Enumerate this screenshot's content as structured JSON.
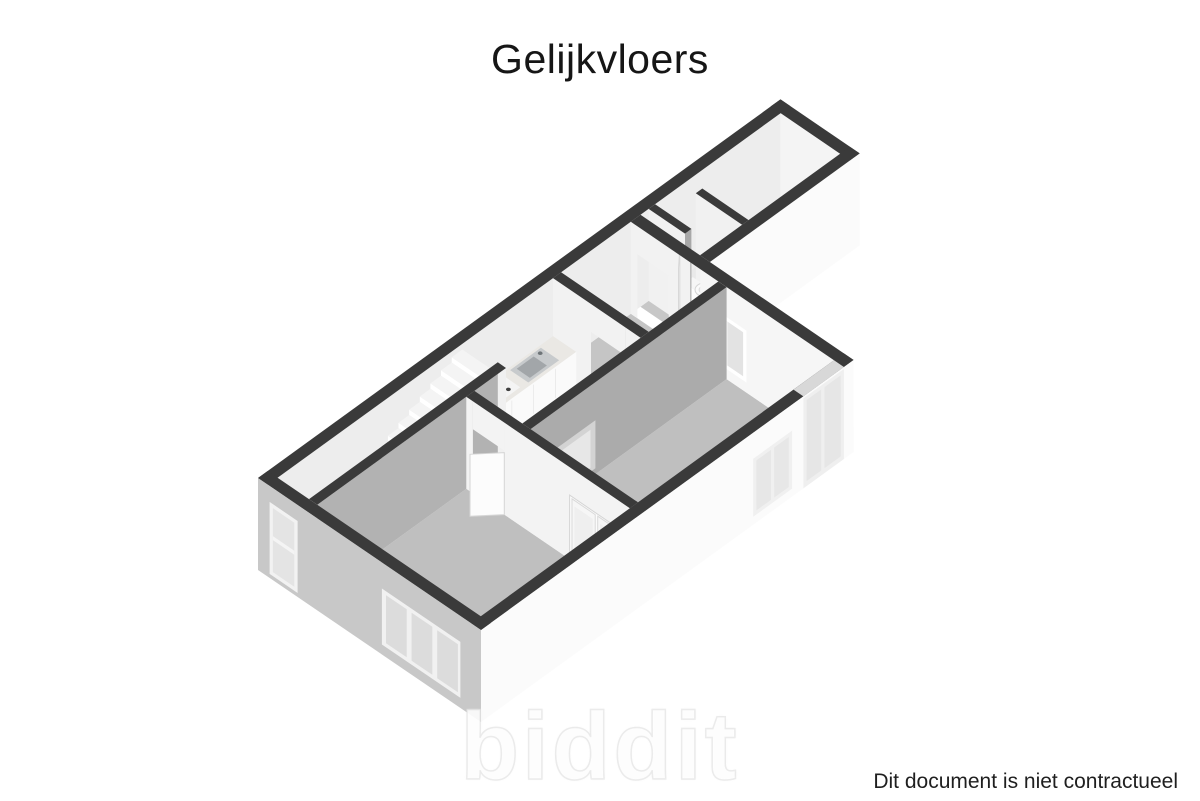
{
  "title": "Gelijkvloers",
  "watermark": "biddit",
  "footer": {
    "disclaimer": "Dit document is niet contractueel"
  },
  "colors": {
    "background": "#ffffff",
    "wall_top": "#3a3a3a",
    "facade_shaded": "#c8c8c8",
    "facade_lit": "#fbfbfb",
    "wall_inner_light": "#f2f2f2",
    "wall_inner_shaded": "#ababab",
    "floor_main": "#bfbfbf",
    "floor_light": "#ebebeb",
    "floor_hall": "#c5c5c5",
    "text": "#161616"
  },
  "floorplan": {
    "type": "3d-floorplan-render",
    "floor_label": "Gelijkvloers",
    "elements": [
      "staircase",
      "kitchen-counter",
      "kitchen-sink",
      "cooktop",
      "toilet",
      "washbasin",
      "interior-door",
      "double-doors",
      "triple-window",
      "tall-window",
      "glazed-door",
      "hall",
      "living-room",
      "front-room",
      "wc"
    ]
  }
}
